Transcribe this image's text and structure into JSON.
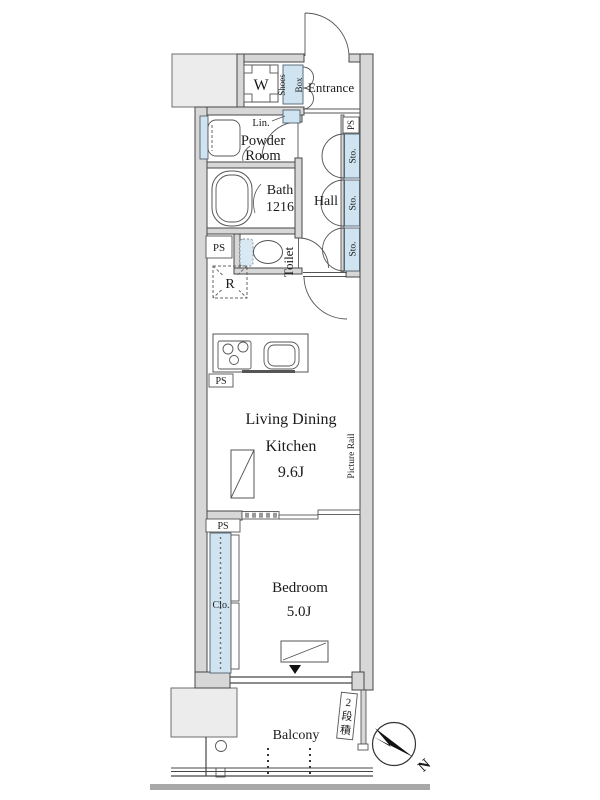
{
  "plan_title": "1K apartment floor plan",
  "colors": {
    "wall_line": "#474747",
    "wall_fill": "#d7d7d7",
    "fixture_blue": "#cfe3f0",
    "neighbor_gray": "#ececec",
    "balcony_band_gray": "#a8a8a8",
    "text": "#1b1b1b",
    "compass_black": "#111111"
  },
  "labels": {
    "washer": "W",
    "shoes_box": [
      "Shoes",
      "Box"
    ],
    "entrance": "Entrance",
    "linen": "Lin.",
    "powder_room": [
      "Powder",
      "Room"
    ],
    "ps": "PS",
    "bath": "Bath",
    "bath_size": "1216",
    "hall": "Hall",
    "storage_units": [
      "Sto.",
      "Sto.",
      "Sto."
    ],
    "toilet": "Toilet",
    "refrigerator": "R",
    "ldk_lines": [
      "Living Dining",
      "Kitchen"
    ],
    "ldk_size": "9.6J",
    "picture_rail": "Picture Rail",
    "closet": "Clo.",
    "bedroom": "Bedroom",
    "bedroom_size": "5.0J",
    "balcony": "Balcony",
    "ac_note": "2段積",
    "ac_note_chars": [
      "2",
      "段",
      "積"
    ],
    "compass_north": "N"
  }
}
